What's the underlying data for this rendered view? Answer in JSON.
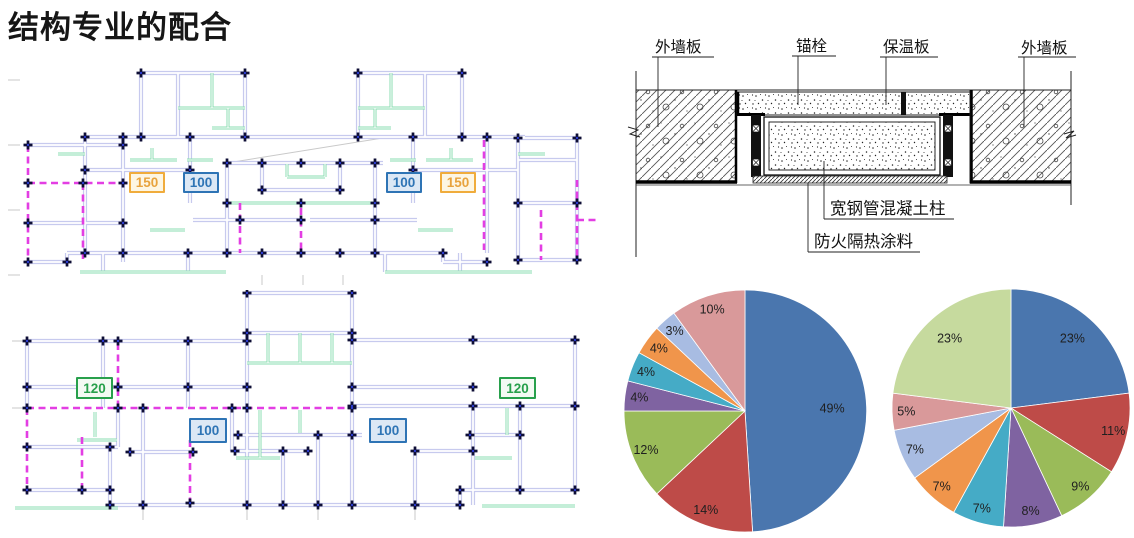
{
  "title": "结构专业的配合",
  "floor_plans": {
    "top_plan": {
      "labels": [
        "150",
        "100",
        "100",
        "150"
      ],
      "label_styles": [
        "orange",
        "blue",
        "blue",
        "orange"
      ]
    },
    "bottom_plan": {
      "labels": [
        "120",
        "100",
        "100",
        "120"
      ],
      "label_styles": [
        "green",
        "blue",
        "blue",
        "green"
      ]
    }
  },
  "detail_drawing": {
    "top_labels": [
      "外墙板",
      "锚栓",
      "保温板",
      "外墙板"
    ],
    "bottom_labels": [
      "宽钢管混凝土柱",
      "防火隔热涂料"
    ]
  },
  "colors": {
    "label_orange": "#E8A33D",
    "label_blue": "#2E74B5",
    "label_green": "#28A04C",
    "wall": "#C7CAEE",
    "green_line": "#8ADCB0",
    "magenta_dashed": "#E33EE3"
  },
  "chart_data": [
    {
      "type": "pie",
      "title": "",
      "legend": false,
      "start_angle_deg": 0,
      "direction": "clockwise",
      "values": [
        49,
        14,
        12,
        4,
        4,
        4,
        3,
        10
      ],
      "labels": [
        "49%",
        "14%",
        "12%",
        "4%",
        "4%",
        "4%",
        "3%",
        "10%"
      ],
      "colors": [
        "#4A76AE",
        "#BE4B48",
        "#9ABB59",
        "#7F63A1",
        "#45ABC6",
        "#F0954B",
        "#A8BCE2",
        "#D9999A"
      ]
    },
    {
      "type": "pie",
      "title": "",
      "legend": false,
      "start_angle_deg": 0,
      "direction": "clockwise",
      "values": [
        23,
        11,
        9,
        8,
        7,
        7,
        7,
        5,
        23
      ],
      "labels": [
        "23%",
        "11%",
        "9%",
        "8%",
        "7%",
        "7%",
        "7%",
        "5%",
        "23%"
      ],
      "colors": [
        "#4A76AE",
        "#BE4B48",
        "#9ABB59",
        "#7F63A1",
        "#45ABC6",
        "#F0954B",
        "#A8BCE2",
        "#D9999A",
        "#C6DA9E"
      ]
    }
  ]
}
